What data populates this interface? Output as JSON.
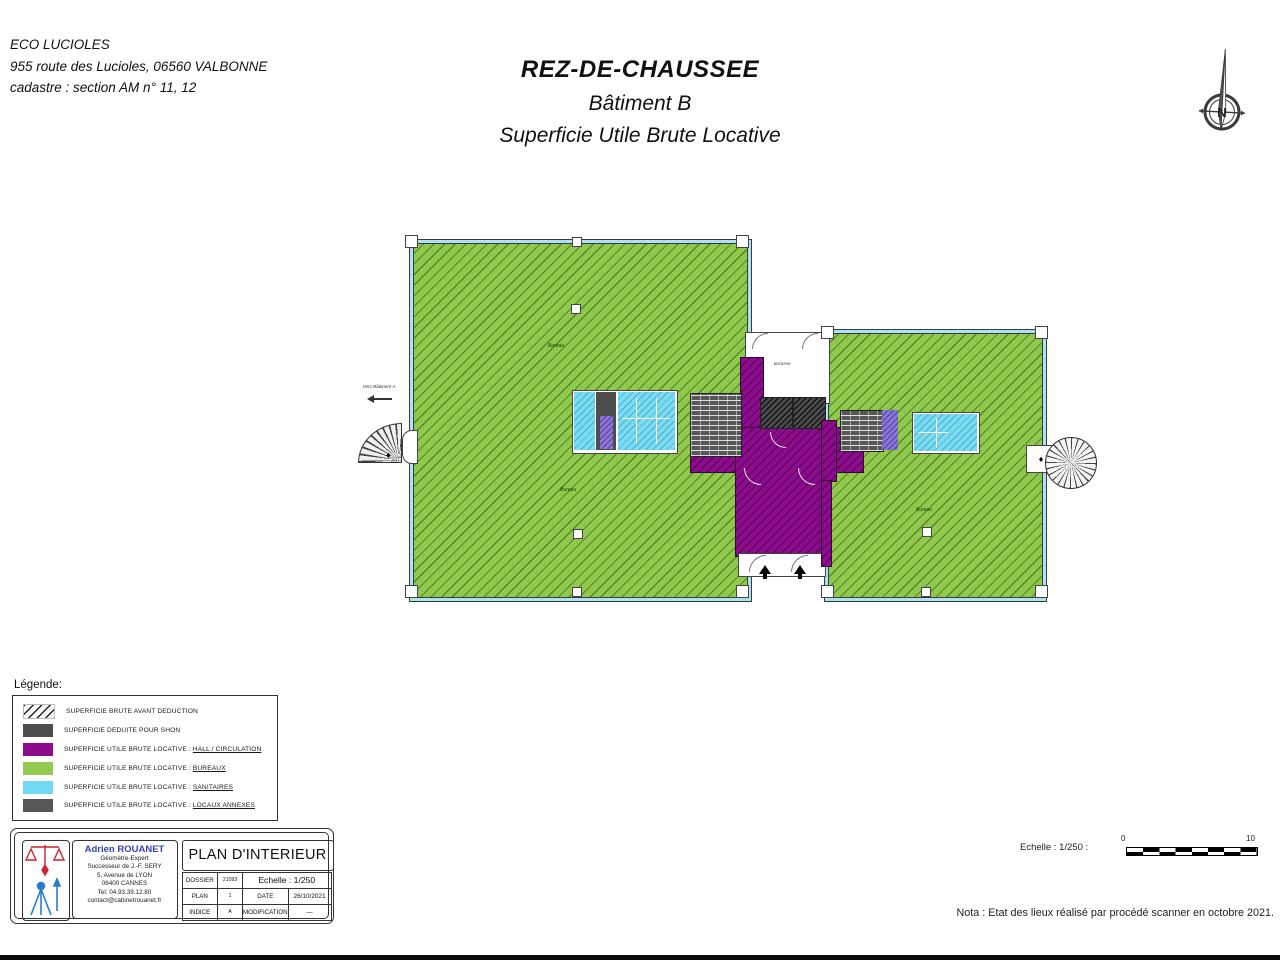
{
  "header": {
    "project_name": "ECO LUCIOLES",
    "project_address": "955 route des Lucioles, 06560 VALBONNE",
    "project_cadastre": "cadastre : section AM n° 11, 12",
    "title_line1": "REZ-DE-CHAUSSEE",
    "title_line2": "Bâtiment B",
    "title_line3": "Superficie Utile Brute Locative",
    "north_label": "N"
  },
  "plan": {
    "vers_batiment_a": "Vers Bâtiment A",
    "terrasse_label": "terrasse",
    "bureau_label": "Bureau",
    "diamond_glyph": "♦"
  },
  "legend": {
    "title": "Légende:",
    "items": [
      {
        "label": "SUPERFICIE BRUTE AVANT DEDUCTION"
      },
      {
        "label": "SUPERFICIE DEDUITE POUR SHON"
      },
      {
        "prefix": "SUPERFICIE UTILE BRUTE LOCATIVE  : ",
        "sublabel": "HALL / CIRCULATION"
      },
      {
        "prefix": "SUPERFICIE UTILE BRUTE LOCATIVE  : ",
        "sublabel": "BUREAUX"
      },
      {
        "prefix": "SUPERFICIE UTILE BRUTE LOCATIVE  : ",
        "sublabel": "SANITAIRES"
      },
      {
        "prefix": "SUPERFICIE UTILE BRUTE LOCATIVE  : ",
        "sublabel": "LOCAUX ANNEXES"
      }
    ]
  },
  "titleblock": {
    "firm_name": "Adrien ROUANET",
    "firm_role": "Géomètre-Expert",
    "firm_successor": "Successeur de J.-F. SERY",
    "firm_address1": "5, Avenue de LYON",
    "firm_address2": "06400 CANNES",
    "firm_tel": "Tel: 04.93.39.12.80",
    "firm_email": "contact@cabinetrouanet.fr",
    "doc_title": "PLAN D'INTERIEUR",
    "table": {
      "dossier_label": "DOSSIER",
      "dossier_value": "21093",
      "echelle_label": "Echelle  :  1/250",
      "plan_label": "PLAN",
      "plan_value": "1",
      "date_label": "DATE",
      "date_value": "26/10/2021",
      "indice_label": "INDICE",
      "indice_value": "A",
      "modification_label": "MODIFICATION",
      "modification_value": "—"
    }
  },
  "footer": {
    "scale_text": "Echelle  :  1/250  :",
    "scale_zero": "0",
    "scale_ten": "10",
    "nota": "Nota : Etat des lieux réalisé par procédé scanner en octobre 2021."
  },
  "colors": {
    "bureaux": "#92c94e",
    "hall_circulation": "#8c0a8c",
    "sanitaires": "#72d9f2",
    "shon_deduit": "#4d4d4d",
    "locaux_annexes": "#575757",
    "curtain_wall": "#abe3f2"
  }
}
